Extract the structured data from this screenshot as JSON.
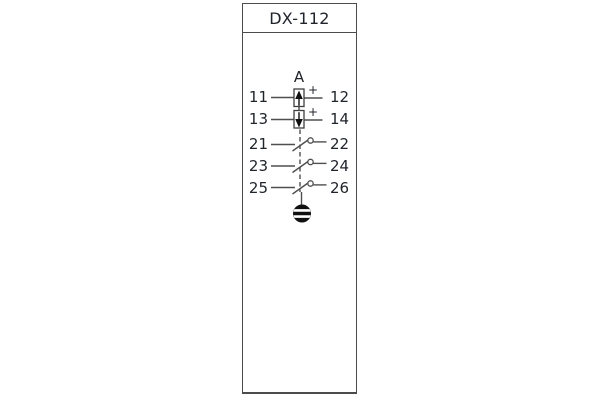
{
  "device": {
    "title": "DX-112"
  },
  "schematic": {
    "coil_label": "A",
    "polarity_mark": "+",
    "rows": [
      {
        "left": "11",
        "right": "12",
        "type": "polarized-element-up"
      },
      {
        "left": "13",
        "right": "14",
        "type": "polarized-element-down"
      },
      {
        "left": "21",
        "right": "22",
        "type": "switch-contact"
      },
      {
        "left": "23",
        "right": "24",
        "type": "switch-contact"
      },
      {
        "left": "25",
        "right": "26",
        "type": "switch-contact"
      }
    ],
    "bottom_symbol": "screw-terminal",
    "colors": {
      "line": "#4f4f4f",
      "text": "#20242b",
      "symbol_fill": "#101010",
      "frame_border": "#4c4c4c",
      "background": "#ffffff"
    }
  }
}
